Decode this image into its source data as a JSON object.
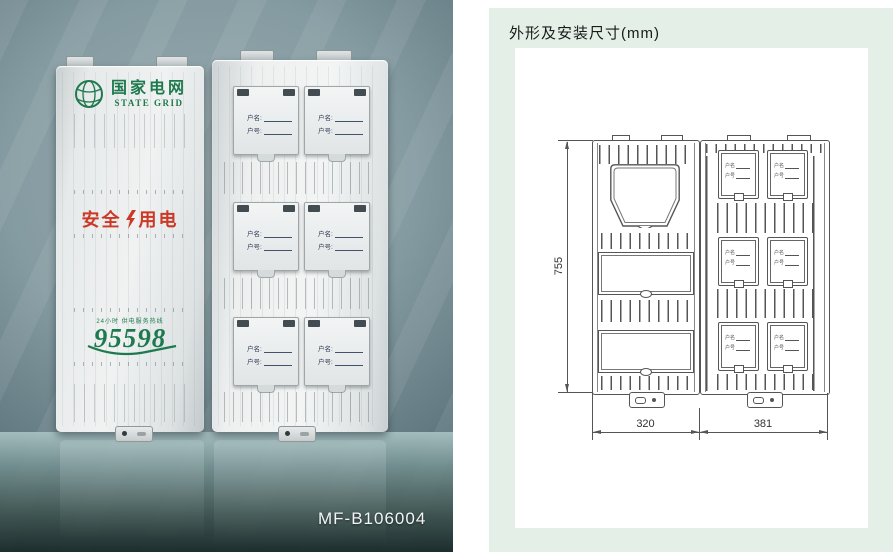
{
  "photo": {
    "model_label": "MF-B106004",
    "brand": {
      "name_cn": "国家电网",
      "name_en": "STATE GRID"
    },
    "safety_slogan": {
      "left": "安全",
      "right": "用电"
    },
    "hotline": {
      "caption": "24小时 供电服务热线",
      "number": "95598"
    },
    "meter_cover_labels": {
      "name": "户名:",
      "number": "户号:"
    }
  },
  "drawing": {
    "title": "外形及安装尺寸(mm)",
    "dimensions": {
      "height": "755",
      "width_left": "320",
      "width_right": "381"
    },
    "window_labels": {
      "name": "户名",
      "number": "户号"
    }
  },
  "icons": {
    "state_grid_logo": "green-globe-with-meridians",
    "lightning": "red-lightning-bolt",
    "hotline_swoosh": "green-swoosh-underline"
  },
  "colors": {
    "brand_green": "#1e7a4e",
    "safety_red": "#cd3826",
    "panel_green": "#e4efe8",
    "drawing_line": "#555555"
  }
}
